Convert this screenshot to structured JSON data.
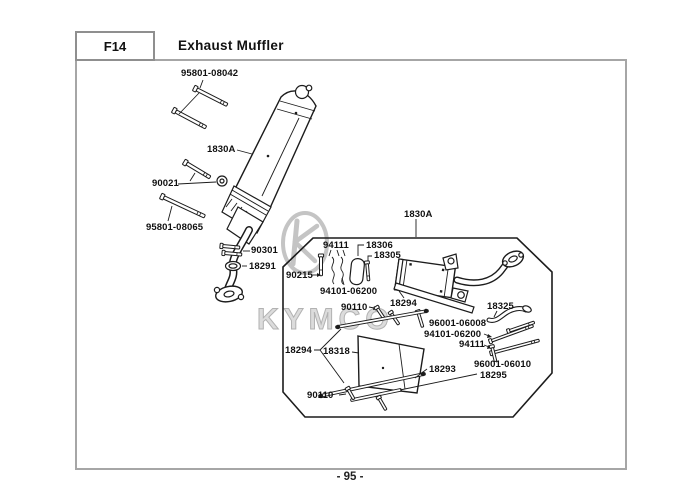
{
  "header": {
    "section_code": "F14",
    "title": "Exhaust Muffler"
  },
  "footer": {
    "page_number": "- 95 -"
  },
  "watermark": {
    "brand": "KYMCO",
    "logo_icon": "kymco-oval-k-logo"
  },
  "colors": {
    "background": "#ffffff",
    "line_art": "#1c1c1c",
    "frame_border": "#a6a6a6",
    "watermark_gray": "#c4c4c4",
    "text": "#101010"
  },
  "diagram": {
    "labels": [
      {
        "text": "95801-08042"
      },
      {
        "text": "1830A"
      },
      {
        "text": "90021"
      },
      {
        "text": "95801-08065"
      },
      {
        "text": "90301"
      },
      {
        "text": "18291"
      },
      {
        "text": "1830A"
      },
      {
        "text": "94111"
      },
      {
        "text": "18306"
      },
      {
        "text": "18305"
      },
      {
        "text": "90215"
      },
      {
        "text": "94101-06200"
      },
      {
        "text": "18294"
      },
      {
        "text": "90110"
      },
      {
        "text": "96001-06008"
      },
      {
        "text": "94101-06200"
      },
      {
        "text": "94111"
      },
      {
        "text": "18325"
      },
      {
        "text": "18294"
      },
      {
        "text": "18318"
      },
      {
        "text": "18293"
      },
      {
        "text": "96001-06010"
      },
      {
        "text": "18295"
      },
      {
        "text": "90110"
      }
    ]
  }
}
